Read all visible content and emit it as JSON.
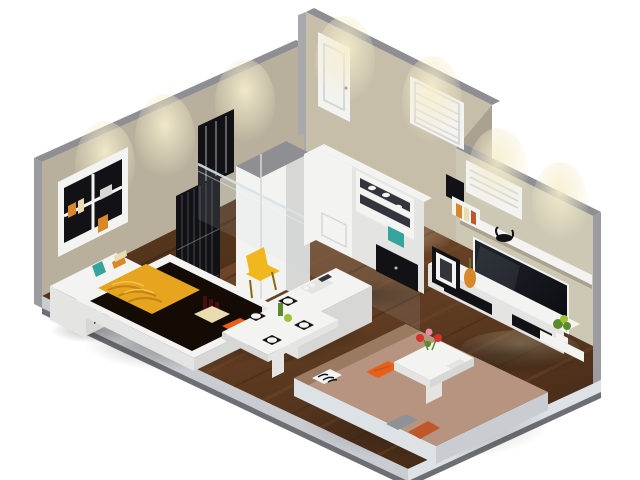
{
  "meta": {
    "type": "3d-isometric-render",
    "description": "Isometric 3D cutaway render of a small studio apartment floor plan with bedroom, open kitchen, dining nook, entry hall and living room",
    "canvas_width": 640,
    "canvas_height": 480
  },
  "scene": {
    "rooms": [
      {
        "name": "bedroom",
        "position": "left"
      },
      {
        "name": "kitchen",
        "position": "center-back"
      },
      {
        "name": "dining-nook",
        "position": "center"
      },
      {
        "name": "entry-hall",
        "position": "top-right"
      },
      {
        "name": "living-room",
        "position": "bottom-right"
      }
    ],
    "architecture": {
      "walls": "gray cut-top walls with beige interior faces",
      "floor": "dark walnut plank flooring",
      "door_count": 1,
      "window_count": 3,
      "glass_partition": true,
      "downlight_washes": 7
    },
    "furniture": [
      {
        "name": "platform-bed",
        "colors": [
          "white",
          "gold",
          "dark-brown"
        ]
      },
      {
        "name": "gold-blanket",
        "colors": [
          "gold"
        ]
      },
      {
        "name": "wall-shelf-with-books",
        "colors": [
          "white",
          "black",
          "orange"
        ]
      },
      {
        "name": "dresser",
        "colors": [
          "white",
          "teal"
        ]
      },
      {
        "name": "black-slatted-screen",
        "colors": [
          "black"
        ]
      },
      {
        "name": "wardrobe-column",
        "colors": [
          "white"
        ]
      },
      {
        "name": "kitchen-cabinet-unit",
        "colors": [
          "white",
          "black",
          "teal"
        ]
      },
      {
        "name": "kitchen-island",
        "colors": [
          "white"
        ]
      },
      {
        "name": "dining-table",
        "colors": [
          "white",
          "black"
        ]
      },
      {
        "name": "placemats",
        "count": 4,
        "colors": [
          "black"
        ]
      },
      {
        "name": "bench-pillows",
        "count": 3,
        "colors": [
          "cream",
          "orange"
        ]
      },
      {
        "name": "yellow-chair",
        "colors": [
          "yellow"
        ]
      },
      {
        "name": "sectional-sofa-platform",
        "colors": [
          "tan",
          "white"
        ]
      },
      {
        "name": "sofa-pillows",
        "count": 4,
        "colors": [
          "orange",
          "zebra",
          "gray",
          "rust"
        ]
      },
      {
        "name": "coffee-table-with-flowers",
        "colors": [
          "white",
          "red",
          "pink"
        ]
      },
      {
        "name": "tv-media-wall",
        "colors": [
          "white",
          "black"
        ]
      },
      {
        "name": "tv-screen",
        "colors": [
          "black"
        ]
      },
      {
        "name": "picture-frame-and-vase",
        "colors": [
          "black",
          "orange"
        ]
      },
      {
        "name": "plant",
        "colors": [
          "green"
        ]
      },
      {
        "name": "bull-figurine",
        "colors": [
          "black"
        ]
      }
    ]
  },
  "palette": {
    "background": "#ffffff",
    "wallTop": "#8e8e93",
    "wallCap": "#a9a9ad",
    "wallOuter": "#9b9ba0",
    "wallBeige": "#b8b09c",
    "wallBeigeLight": "#c6bea9",
    "wallShadow": "#aaa290",
    "wallGreen": "#ccc8b4",
    "glow": "#f6eecd",
    "floorWoodLight": "#7a4e2c",
    "floorWoodDark": "#462b18",
    "floorTint": "#140b04",
    "slabLight": "#c9cdd1",
    "slabLighter": "#dde2e6",
    "slabDark": "#6e6f74",
    "white": "#f3f3f1",
    "white2": "#e4e4e2",
    "white3": "#d7d7d5",
    "black": "#121216",
    "blackSoft": "#34343c",
    "steel": "#b9bec2",
    "gold": "#e6a41f",
    "goldDark": "#b97c10",
    "goldLight": "#f7cc55",
    "orange": "#e95f17",
    "rust": "#c0572a",
    "cream": "#e9dcb0",
    "tan": "#b69480",
    "tanDark": "#9b7a62",
    "teal": "#36a39c",
    "yellow": "#f0b81e",
    "yellowDark": "#8a6a10",
    "green": "#5a8a2a",
    "greenLight": "#9cc23a",
    "red": "#d8302a",
    "pink": "#e88aa0",
    "wine": "#4a0d12",
    "bookOrange": "#d8882a",
    "grayPillow": "#8e9296",
    "glassTint": "#cfe0e6",
    "glassEdge": "#d8e4e8",
    "tvDark": "#20262e",
    "tvBlack": "#0a0b0f",
    "shadow": "#000000"
  }
}
